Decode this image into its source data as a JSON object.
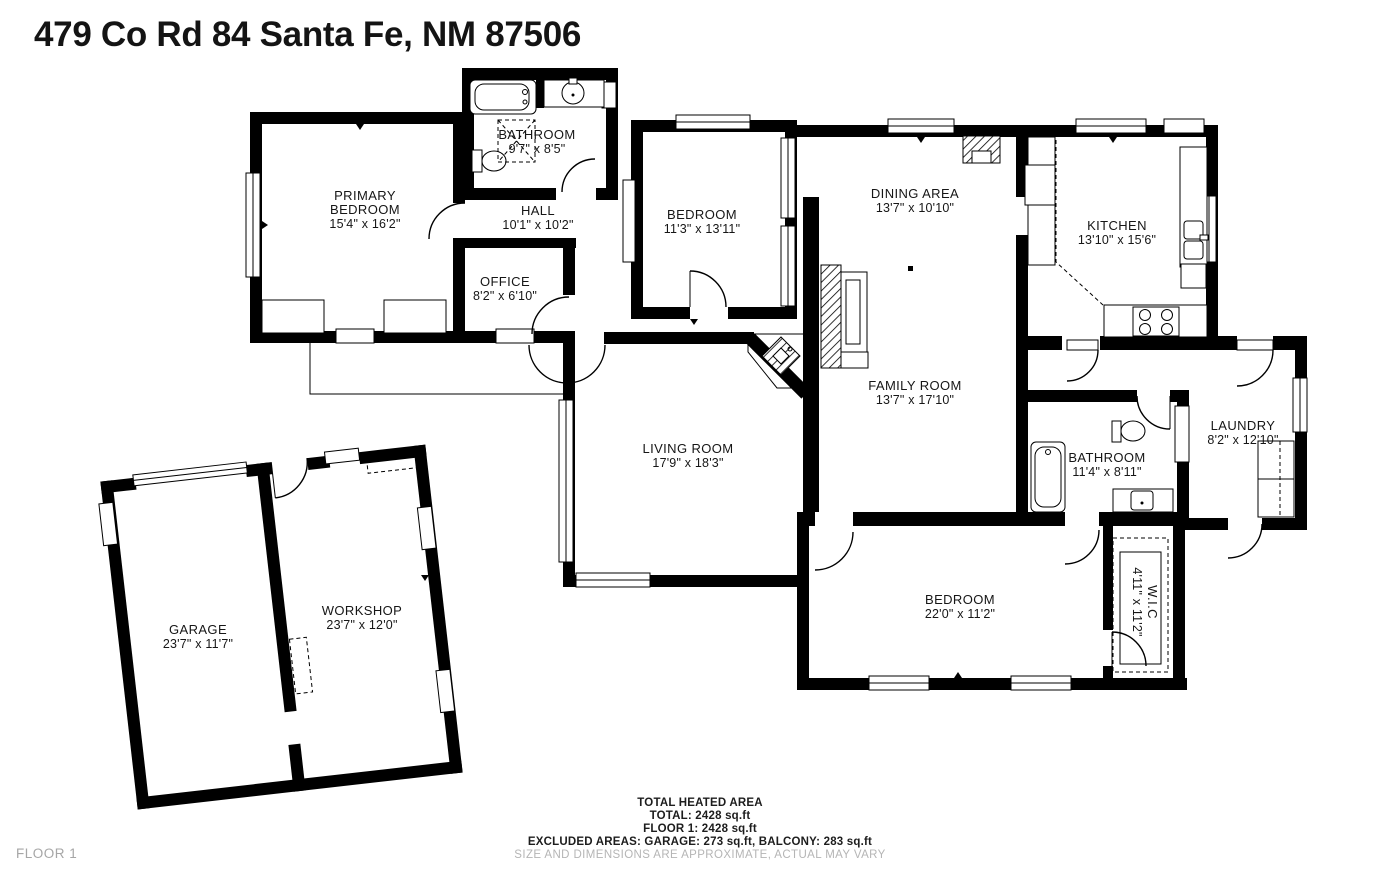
{
  "title": "479 Co Rd 84 Santa Fe, NM 87506",
  "floor_badge": "FLOOR 1",
  "rooms": {
    "primary_bedroom": {
      "name1": "PRIMARY",
      "name2": "BEDROOM",
      "dims": "15'4\" x 16'2\""
    },
    "bathroom_top": {
      "name": "BATHROOM",
      "dims": "9'7\" x 8'5\""
    },
    "hall": {
      "name": "HALL",
      "dims": "10'1\" x 10'2\""
    },
    "office": {
      "name": "OFFICE",
      "dims": "8'2\" x 6'10\""
    },
    "bedroom_mid": {
      "name": "BEDROOM",
      "dims": "11'3\" x 13'11\""
    },
    "dining": {
      "name": "DINING AREA",
      "dims": "13'7\" x 10'10\""
    },
    "kitchen": {
      "name": "KITCHEN",
      "dims": "13'10\" x 15'6\""
    },
    "family": {
      "name": "FAMILY ROOM",
      "dims": "13'7\" x 17'10\""
    },
    "living": {
      "name": "LIVING ROOM",
      "dims": "17'9\" x 18'3\""
    },
    "bathroom_right": {
      "name": "BATHROOM",
      "dims": "11'4\" x 8'11\""
    },
    "laundry": {
      "name": "LAUNDRY",
      "dims": "8'2\" x 12'10\""
    },
    "bedroom_bottom": {
      "name": "BEDROOM",
      "dims": "22'0\" x 11'2\""
    },
    "wic": {
      "name": "W.I.C",
      "dims": "4'11\" x 11'2\""
    },
    "garage": {
      "name": "GARAGE",
      "dims": "23'7\" x 11'7\""
    },
    "workshop": {
      "name": "WORKSHOP",
      "dims": "23'7\" x 12'0\""
    }
  },
  "summary": {
    "line1": "TOTAL HEATED AREA",
    "line2": "TOTAL: 2428 sq.ft",
    "line3": "FLOOR 1: 2428 sq.ft",
    "line4": "EXCLUDED AREAS: GARAGE: 273 sq.ft, BALCONY: 283 sq.ft",
    "line5": "SIZE AND DIMENSIONS ARE APPROXIMATE, ACTUAL MAY VARY"
  },
  "colors": {
    "wall": "#000000",
    "background": "#ffffff",
    "muted_text": "#b5b5b5"
  }
}
